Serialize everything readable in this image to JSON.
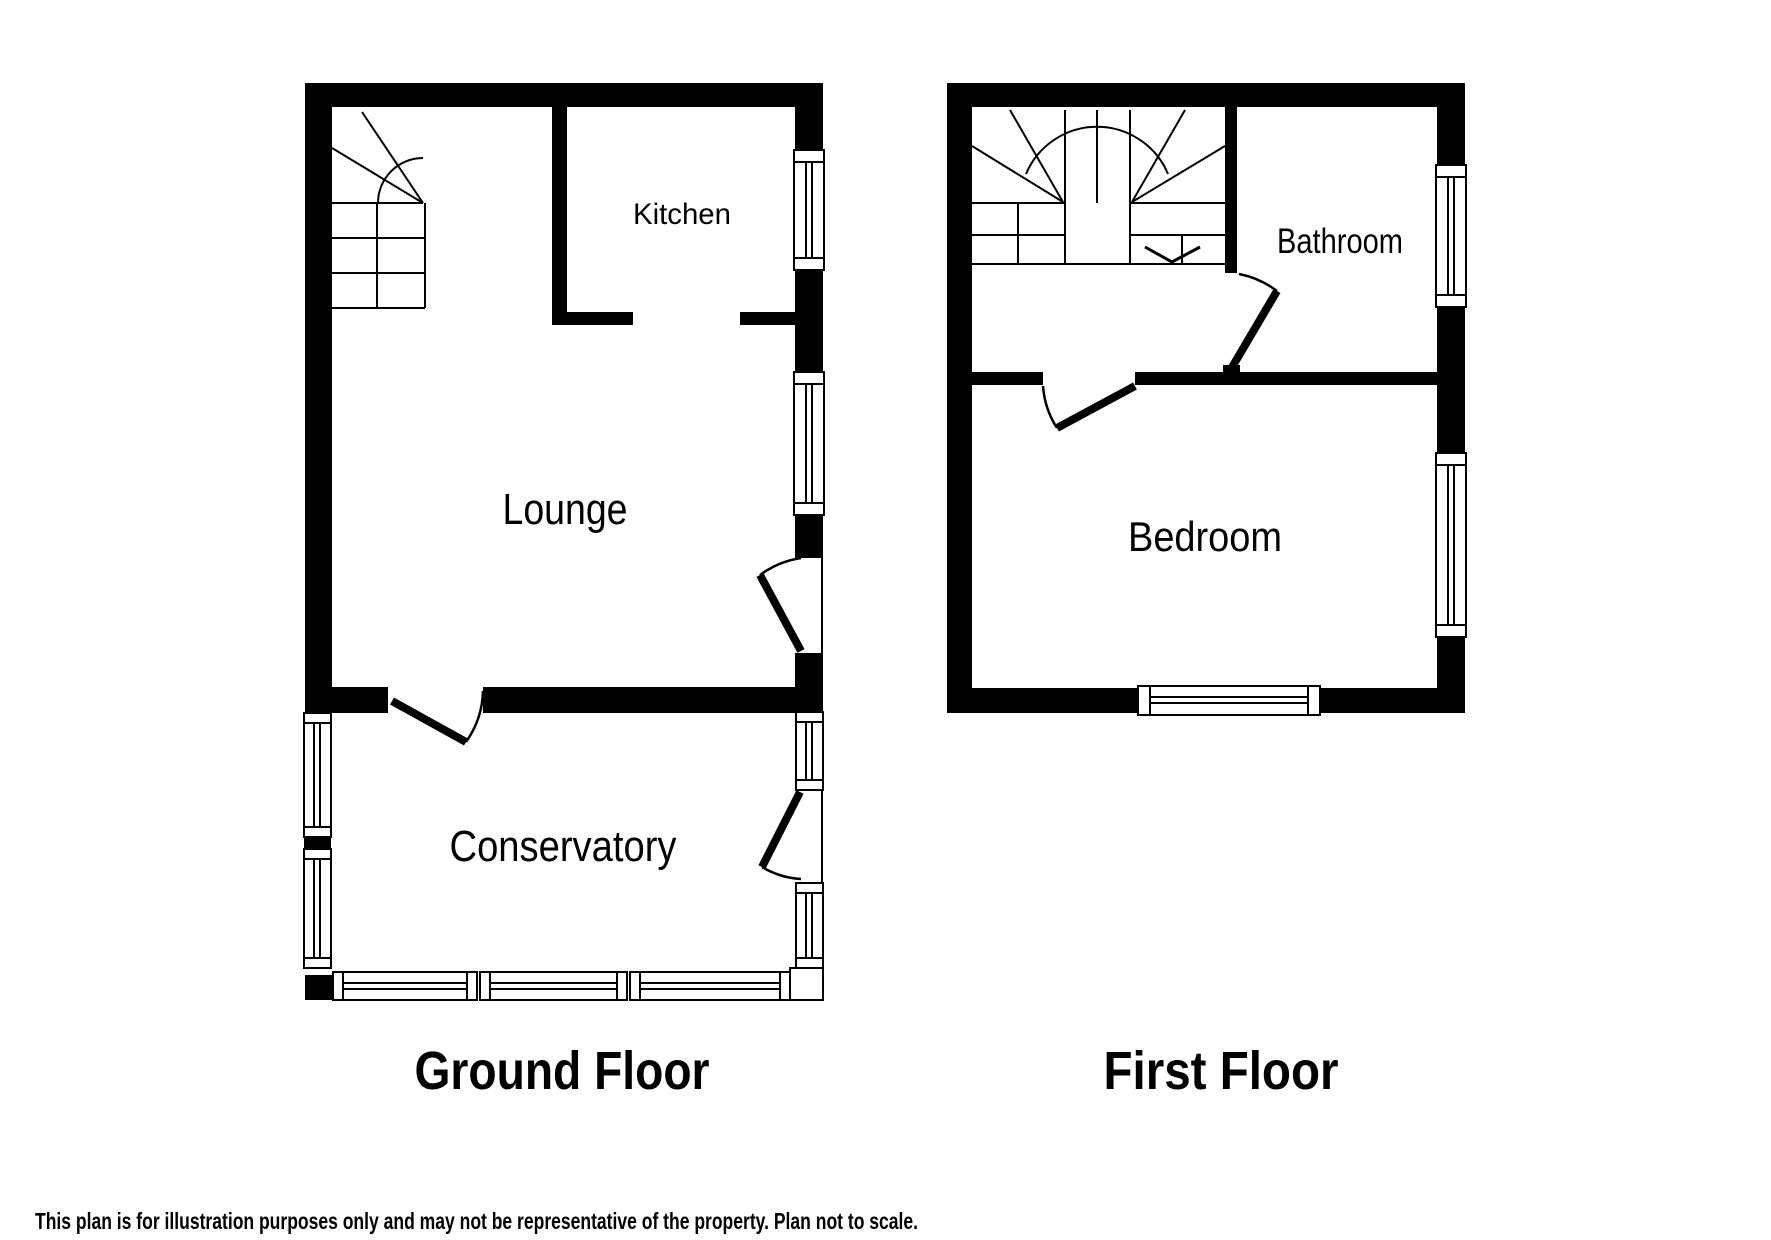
{
  "ground_floor": {
    "title": "Ground Floor",
    "rooms": {
      "kitchen": "Kitchen",
      "lounge": "Lounge",
      "conservatory": "Conservatory"
    }
  },
  "first_floor": {
    "title": "First Floor",
    "rooms": {
      "bathroom": "Bathroom",
      "bedroom": "Bedroom"
    }
  },
  "disclaimer": "This plan is for illustration purposes only and may not be representative of the property. Plan not to scale.",
  "colors": {
    "walls": "#000000",
    "background": "#ffffff",
    "text": "#000000"
  }
}
